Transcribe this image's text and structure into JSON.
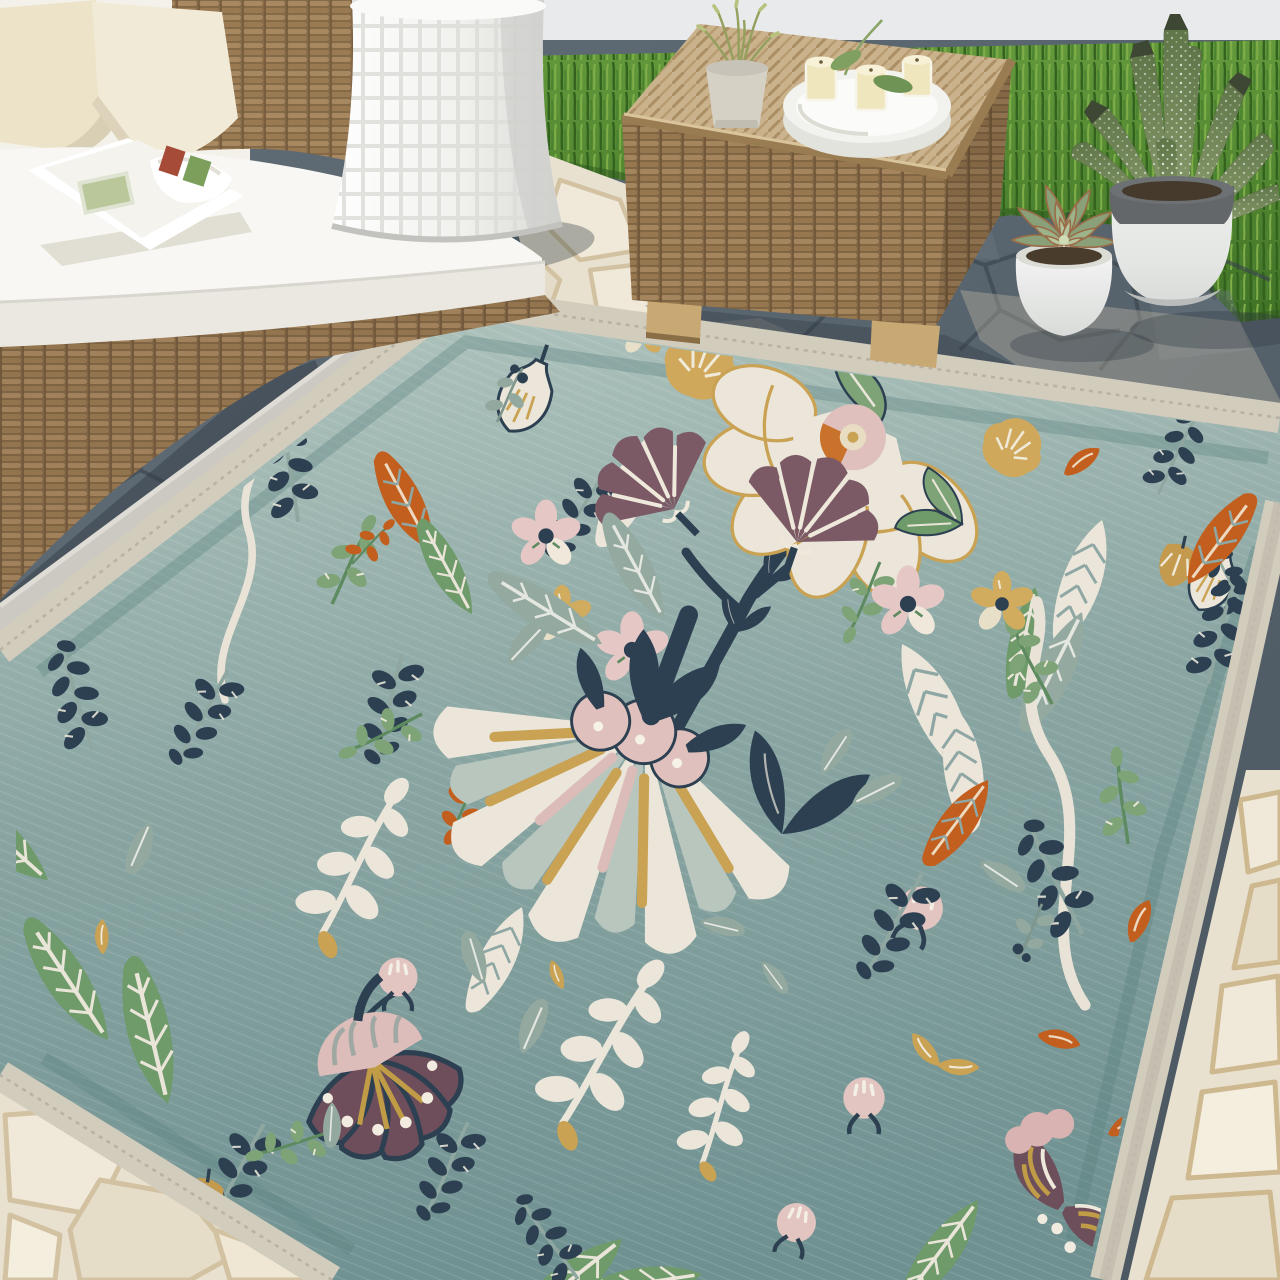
{
  "scene": {
    "kind": "product-lifestyle-photo",
    "setting": "sunny outdoor patio with stone paving, lawn strip and white wall",
    "focal_item": "teal floral indoor-outdoor area rug"
  },
  "palette": {
    "wall": "#e9eaeb",
    "grass": "#549034",
    "grass_dark": "#33621f",
    "grass_light": "#7fae49",
    "slate": "#5b6771",
    "slate_grout": "#39434c",
    "flagstone": "#eae2cf",
    "flagstone_grout": "#cdb88f",
    "rug_field_light": "#aec2bc",
    "rug_field_deep": "#6f9191",
    "rug_binding": "#d2ccbd",
    "rug_inner_border": "#58807e",
    "motif_cream": "#ebe6d9",
    "motif_navy": "#2c4052",
    "motif_green": "#6f9a6a",
    "motif_sage": "#94aaa0",
    "motif_gold": "#c9a254",
    "motif_orange": "#c25f1e",
    "motif_pink": "#e2c4c0",
    "motif_mauve": "#7b5a66",
    "motif_plum": "#6e4e5b",
    "wicker": "#a98a5f",
    "wicker_light": "#c9b28c",
    "cushion_white": "#f8f7f3",
    "pillow_cream": "#ece3c8",
    "stool_white": "#f3f3f0",
    "tray_white": "#f2f2ee",
    "candle_wax": "#efe6bd",
    "pot_white": "#ecedec",
    "pot_rim_gray": "#63676a",
    "aloe_green": "#7e9066",
    "succulent_green": "#93a681"
  },
  "objects": {
    "sofa": {
      "label": "white-cushion wicker outdoor sofa",
      "pillows": 2,
      "extras": [
        "open magazine on seat"
      ]
    },
    "side_stool": {
      "label": "white ceramic drum stool with waffle texture"
    },
    "coffee_table": {
      "label": "woven wicker cube coffee table",
      "on_top": [
        "white round serving tray",
        "three glass candles",
        "leaf sprig",
        "small potted plant"
      ]
    },
    "plants": [
      {
        "label": "wispy green plant in stone pot on table"
      },
      {
        "label": "succulent rosette in white stone pot"
      },
      {
        "label": "speckled aloe in two-tone white/gray pot"
      }
    ],
    "rug": {
      "label": "teal botanical flat-weave rug with cream binding",
      "motifs": [
        "large cream fan flower with gold rays and pink scallop base",
        "cream scallop-edge bloom with pink and orange center",
        "mauve fan flowers on navy stems",
        "plum bell flower with pink cap, gold stamens and white dots",
        "plum paisley flower with gold stripes",
        "navy fern sprigs",
        "green feather leaves with white veins",
        "sage leaves",
        "cream bean-leaf branches",
        "wavy cream vines",
        "orange leaf sprigs",
        "gold tulips and daisies",
        "pink daisies and buds"
      ]
    },
    "floor": {
      "label": "dark slate crazy paving with sunlit cream flagstone edges"
    }
  }
}
